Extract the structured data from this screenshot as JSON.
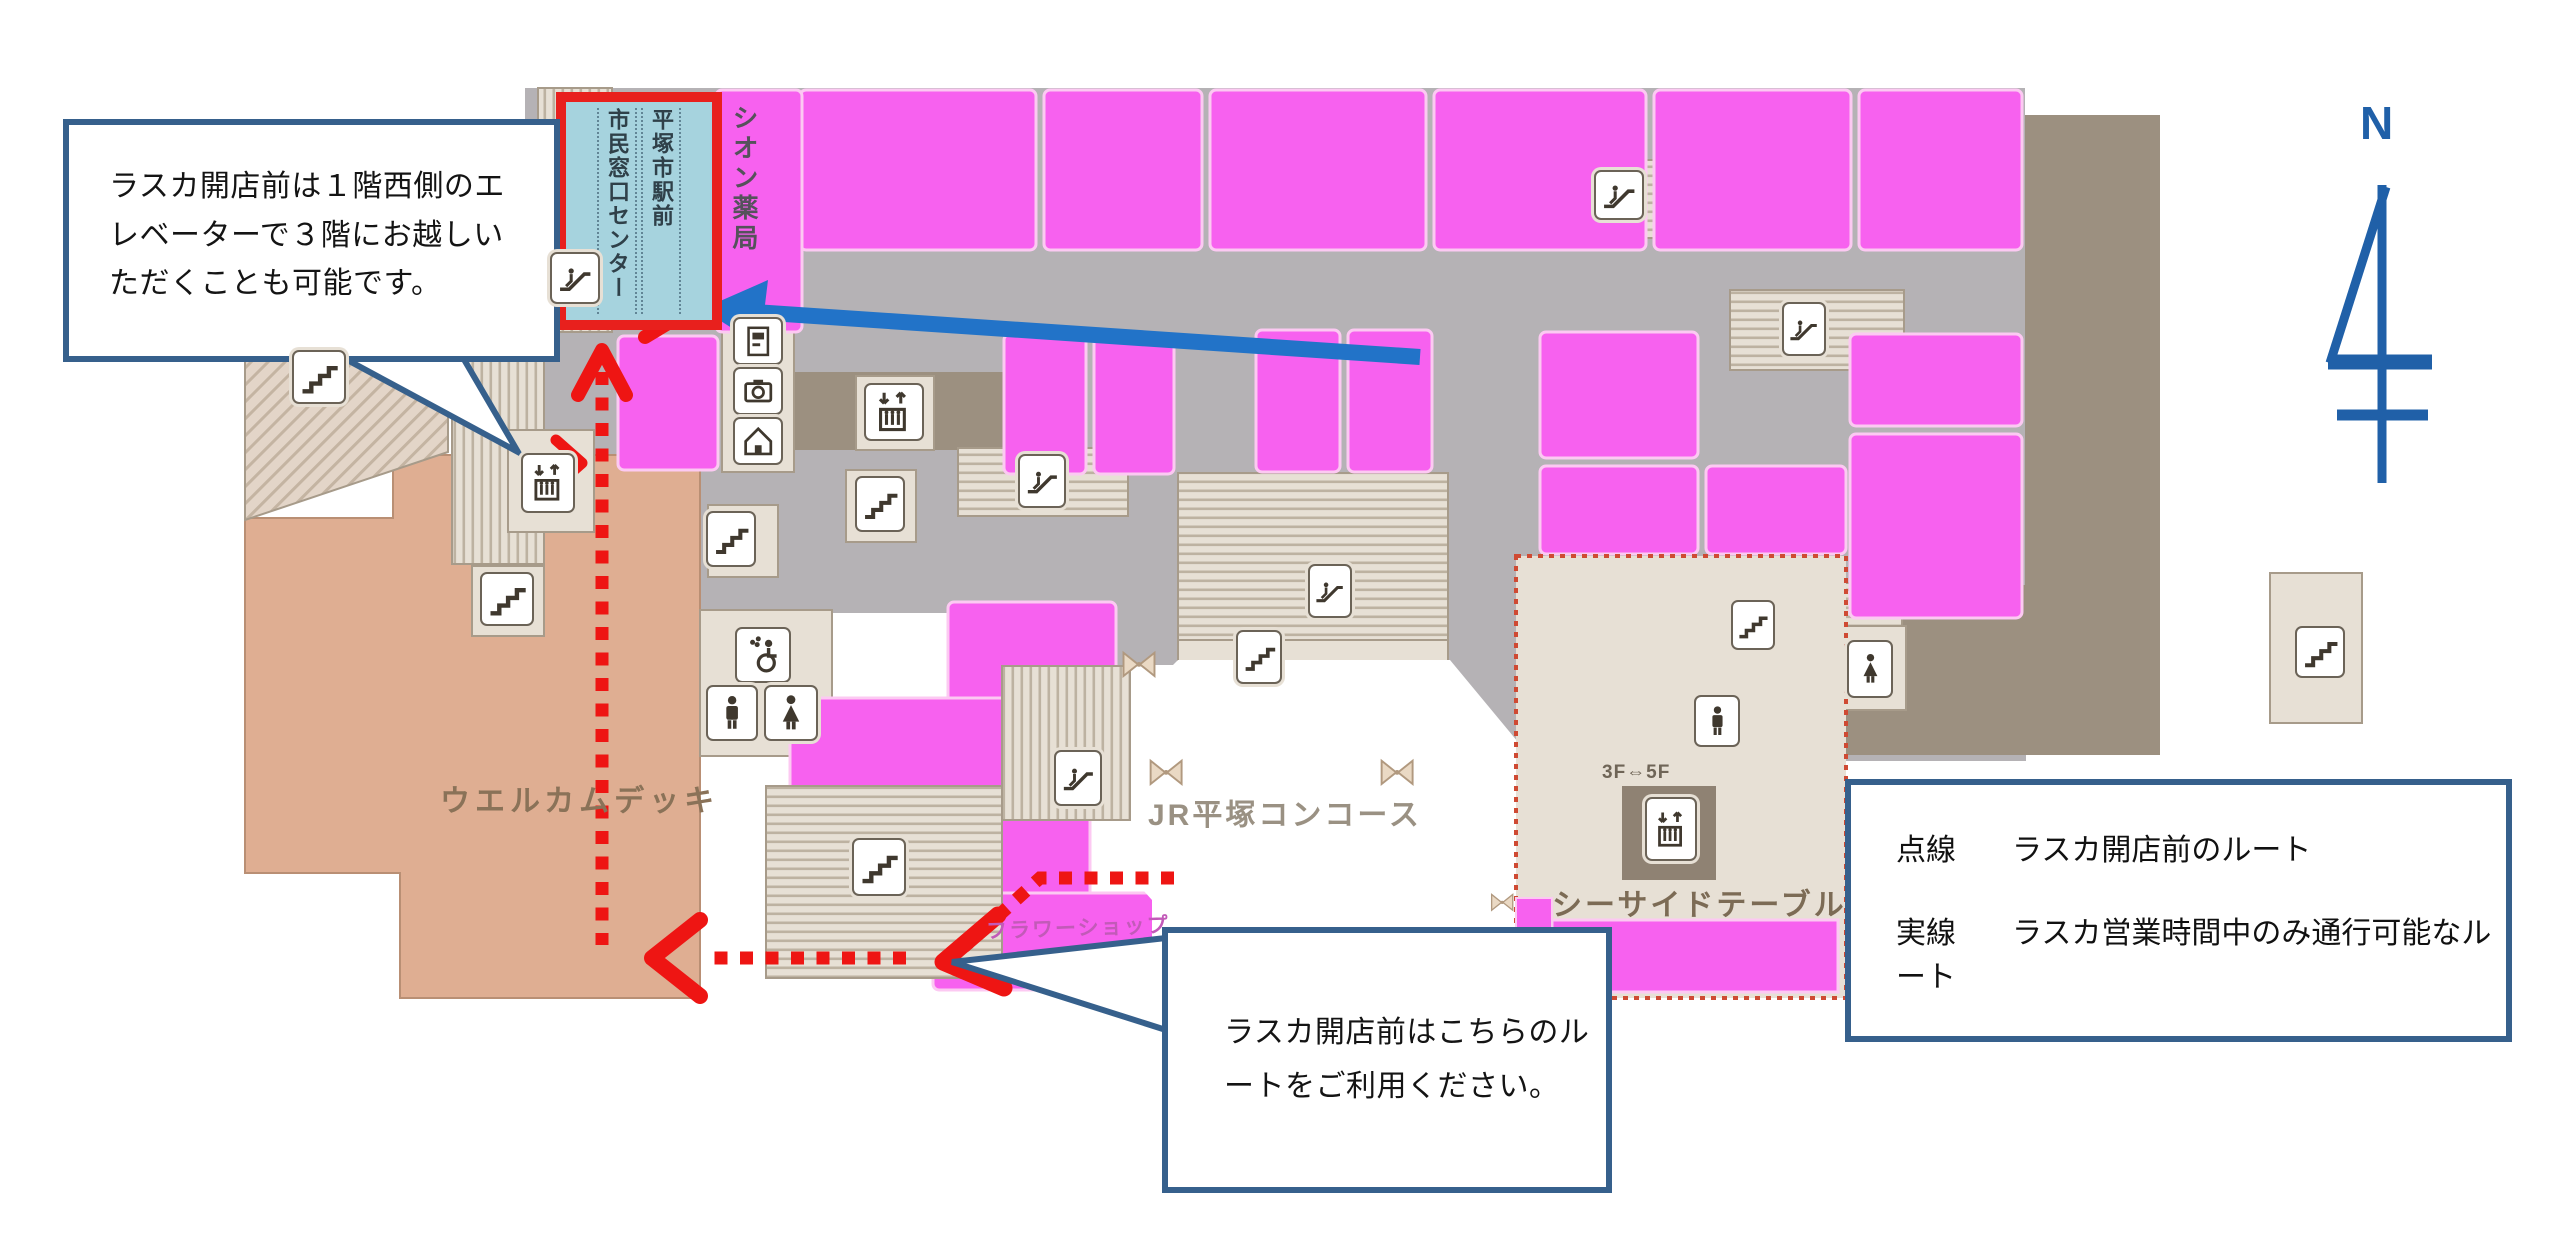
{
  "callouts": {
    "west": {
      "text": "ラスカ開店前は１階西側のエレベーターで３階にお越しいただくことも可能です。"
    },
    "south": {
      "text": "ラスカ開店前はこちらのルートをご利用ください。"
    }
  },
  "legend": {
    "items": [
      {
        "term": "点線",
        "desc": "ラスカ開店前のルート"
      },
      {
        "term": "実線",
        "desc": "ラスカ営業時間中のみ通行可能なルート"
      }
    ]
  },
  "map": {
    "labels": {
      "civic_center_col1": "平塚市駅前",
      "civic_center_col2": "市民窓口センター",
      "pharmacy": "シオン薬局",
      "welcome_deck": "ウエルカムデッキ",
      "jr_concourse": "JR平塚コンコース",
      "seaside_table": "シーサイドテーブル",
      "flower_shop": "フラワーショップ",
      "elevator_floors": "3F⇔5F",
      "compass_north": "N"
    },
    "colors": {
      "shop_pink": "#f761ef",
      "corridor_gray": "#b5b2b5",
      "service_taupe": "#9c9080",
      "structure_beige": "#e7e0d5",
      "deck_tan": "#dfae92",
      "route_red": "#ee1513",
      "arrow_blue": "#2273c8",
      "callout_border_blue": "#36608c",
      "civic_center_fill": "#a6d3de",
      "civic_center_border": "#e8201d",
      "compass_blue": "#2060a8"
    },
    "icons": [
      {
        "name": "west-upper-escalator",
        "type": "escalator",
        "x": 550,
        "y": 252,
        "w": 50,
        "h": 52
      },
      {
        "name": "west-elevator",
        "type": "elevator",
        "x": 521,
        "y": 453,
        "w": 54,
        "h": 60
      },
      {
        "name": "deck-west-stairs",
        "type": "stairs",
        "x": 292,
        "y": 350,
        "w": 54,
        "h": 54
      },
      {
        "name": "deck-mid-stairs",
        "type": "stairs",
        "x": 480,
        "y": 572,
        "w": 54,
        "h": 54
      },
      {
        "name": "info-atm",
        "type": "atm",
        "x": 733,
        "y": 317,
        "w": 50,
        "h": 48
      },
      {
        "name": "info-camera",
        "type": "camera",
        "x": 733,
        "y": 367,
        "w": 50,
        "h": 48
      },
      {
        "name": "info-house",
        "type": "house",
        "x": 733,
        "y": 417,
        "w": 50,
        "h": 48
      },
      {
        "name": "north-elevator",
        "type": "elevator",
        "x": 864,
        "y": 383,
        "w": 60,
        "h": 58
      },
      {
        "name": "central-west-stairs",
        "type": "stairs",
        "x": 706,
        "y": 511,
        "w": 50,
        "h": 56
      },
      {
        "name": "central-stairs",
        "type": "stairs",
        "x": 855,
        "y": 476,
        "w": 50,
        "h": 56
      },
      {
        "name": "north-escalator",
        "type": "escalator",
        "x": 1018,
        "y": 454,
        "w": 48,
        "h": 54
      },
      {
        "name": "south-escalator",
        "type": "escalator",
        "x": 1054,
        "y": 750,
        "w": 48,
        "h": 56
      },
      {
        "name": "grand-stair-escalator",
        "type": "escalator",
        "x": 1308,
        "y": 564,
        "w": 44,
        "h": 54
      },
      {
        "name": "grand-stairs",
        "type": "stairs",
        "x": 1236,
        "y": 630,
        "w": 46,
        "h": 54
      },
      {
        "name": "northeast-escalator",
        "type": "escalator",
        "x": 1594,
        "y": 170,
        "w": 50,
        "h": 50
      },
      {
        "name": "east-escalator",
        "type": "escalator",
        "x": 1782,
        "y": 302,
        "w": 44,
        "h": 54
      },
      {
        "name": "east-stairs",
        "type": "stairs",
        "x": 1731,
        "y": 600,
        "w": 44,
        "h": 50
      },
      {
        "name": "deck-grand-stairs",
        "type": "stairs",
        "x": 852,
        "y": 838,
        "w": 54,
        "h": 58
      },
      {
        "name": "accessible-toilet",
        "type": "toilet-accessible",
        "x": 735,
        "y": 627,
        "w": 56,
        "h": 56
      },
      {
        "name": "mens-toilet",
        "type": "toilet-men",
        "x": 706,
        "y": 685,
        "w": 52,
        "h": 56
      },
      {
        "name": "womens-toilet",
        "type": "toilet-women",
        "x": 764,
        "y": 685,
        "w": 54,
        "h": 56
      },
      {
        "name": "east-mens-toilet",
        "type": "toilet-men",
        "x": 1694,
        "y": 695,
        "w": 46,
        "h": 52
      },
      {
        "name": "east-womens-toilet",
        "type": "toilet-women",
        "x": 1847,
        "y": 640,
        "w": 46,
        "h": 58
      },
      {
        "name": "seaside-elevator",
        "type": "elevator",
        "x": 1645,
        "y": 797,
        "w": 52,
        "h": 64
      },
      {
        "name": "far-east-stairs",
        "type": "stairs",
        "x": 2295,
        "y": 626,
        "w": 50,
        "h": 52
      },
      {
        "name": "gate-bow-1",
        "type": "bow",
        "x": 1114,
        "y": 642,
        "w": 50,
        "h": 44
      },
      {
        "name": "gate-bow-2",
        "type": "bow",
        "x": 1142,
        "y": 750,
        "w": 48,
        "h": 44
      },
      {
        "name": "gate-bow-3",
        "type": "bow",
        "x": 1373,
        "y": 750,
        "w": 48,
        "h": 44
      },
      {
        "name": "gate-bow-4",
        "type": "bow",
        "x": 1487,
        "y": 880,
        "w": 30,
        "h": 44
      }
    ]
  }
}
